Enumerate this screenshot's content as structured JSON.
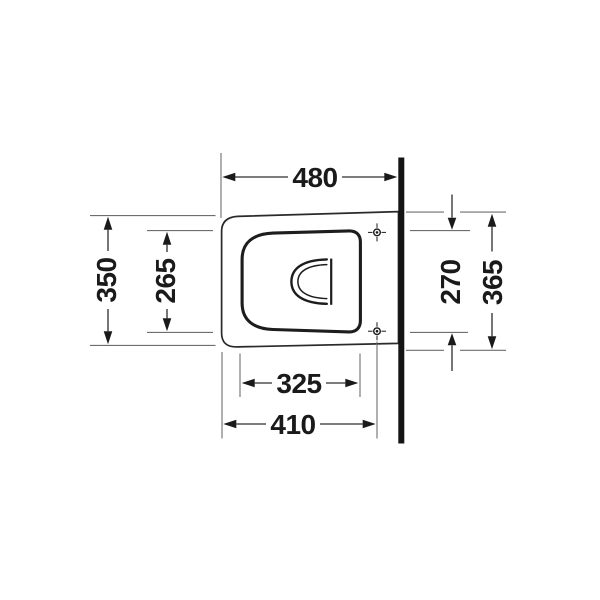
{
  "drawing": {
    "type": "technical-plan-view",
    "dimensions": {
      "top_width": "480",
      "left_outer_depth": "350",
      "left_inner_depth": "265",
      "right_fixing_span": "270",
      "right_outer_depth": "365",
      "bottom_inner_width": "325",
      "bottom_outer_width": "410"
    },
    "colors": {
      "background": "#ffffff",
      "wall": "#141414",
      "outline": "#2a2a2a",
      "dimension_line": "#2d2d2d",
      "extension_line": "#6e6e6e",
      "text": "#1a1a1a"
    }
  }
}
